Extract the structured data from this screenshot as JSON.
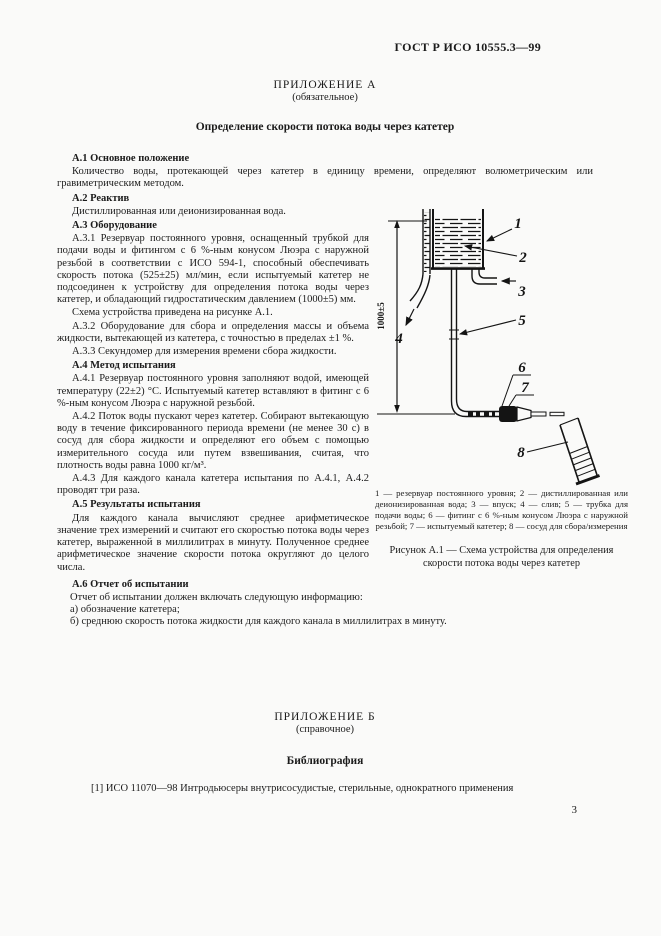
{
  "doc": {
    "standard_number": "ГОСТ Р ИСО 10555.3—99",
    "page_number": "3"
  },
  "appendix_a": {
    "label": "ПРИЛОЖЕНИЕ А",
    "kind": "(обязательное)",
    "title": "Определение скорости потока воды через катетер",
    "sections": [
      {
        "heading": "А.1 Основное положение",
        "paragraphs": [
          "Количество воды, протекающей через катетер в единицу времени, определяют волюметрическим или гравиметрическим методом."
        ]
      },
      {
        "heading": "А.2 Реактив",
        "paragraphs": [
          "Дистиллированная или деионизированная вода."
        ]
      },
      {
        "heading": "А.3 Оборудование",
        "paragraphs": [
          "А.3.1 Резервуар постоянного уровня, оснащенный трубкой для подачи воды и фитингом с 6 %-ным конусом Люэра с наружной резьбой в соответствии с ИСО 594-1, способный обеспечивать скорость потока (525±25) мл/мин, если испытуемый катетер не подсоединен к устройству для определения потока воды через катетер, и обладающий гидростатическим давлением (1000±5) мм.",
          "Схема устройства приведена на рисунке А.1.",
          "А.3.2 Оборудование для сбора и определения массы и объема жидкости, вытекающей из катетера, с точностью в пределах ±1 %.",
          "А.3.3 Секундомер для измерения времени сбора жидкости."
        ]
      },
      {
        "heading": "А.4 Метод испытания",
        "paragraphs": [
          "А.4.1 Резервуар постоянного уровня заполняют водой, имеющей температуру (22±2) °С. Испытуемый катетер вставляют в фитинг с 6 %-ным конусом Люэра с наружной резьбой.",
          "А.4.2 Поток воды пускают через катетер. Собирают вытекающую воду в течение фиксированного периода времени (не менее 30 с) в сосуд для сбора жидкости и определяют его объем с помощью измерительного сосуда или путем взвешивания, считая, что плотность воды равна 1000 кг/м³.",
          "А.4.3 Для каждого канала катетера испытания по А.4.1, А.4.2 проводят три раза."
        ]
      },
      {
        "heading": "А.5 Результаты испытания",
        "paragraphs": [
          "Для каждого канала вычисляют среднее арифметическое значение трех измерений и считают его скоростью потока воды через катетер, выраженной в миллилитрах в минуту. Полученное среднее арифметическое значение скорости потока округляют до целого числа."
        ]
      },
      {
        "heading": "А.6 Отчет об испытании",
        "paragraphs": [
          "Отчет об испытании должен включать следующую информацию:",
          "а) обозначение катетера;",
          "б) среднюю скорость потока жидкости для каждого канала в миллилитрах в минуту."
        ]
      }
    ]
  },
  "figure": {
    "dimension_label": "1000±5",
    "callouts": [
      "1",
      "2",
      "3",
      "4",
      "5",
      "6",
      "7",
      "8"
    ],
    "legend": "1 — резервуар постоянного уровня; 2 — дистиллированная или деионизированная вода; 3 — впуск; 4 — слив; 5 — трубка для подачи воды; 6 — фитинг с 6 %-ным конусом Люэра с наружной резьбой; 7 — испытуемый катетер; 8 — сосуд для сбора/измерения",
    "caption": "Рисунок А.1 — Схема устройства для определения скорости потока воды через катетер"
  },
  "appendix_b": {
    "label": "ПРИЛОЖЕНИЕ Б",
    "kind": "(справочное)",
    "title": "Библиография",
    "reference": "[1] ИСО 11070—98 Интродьюсеры внутрисосудистые, стерильные, однократного применения"
  }
}
